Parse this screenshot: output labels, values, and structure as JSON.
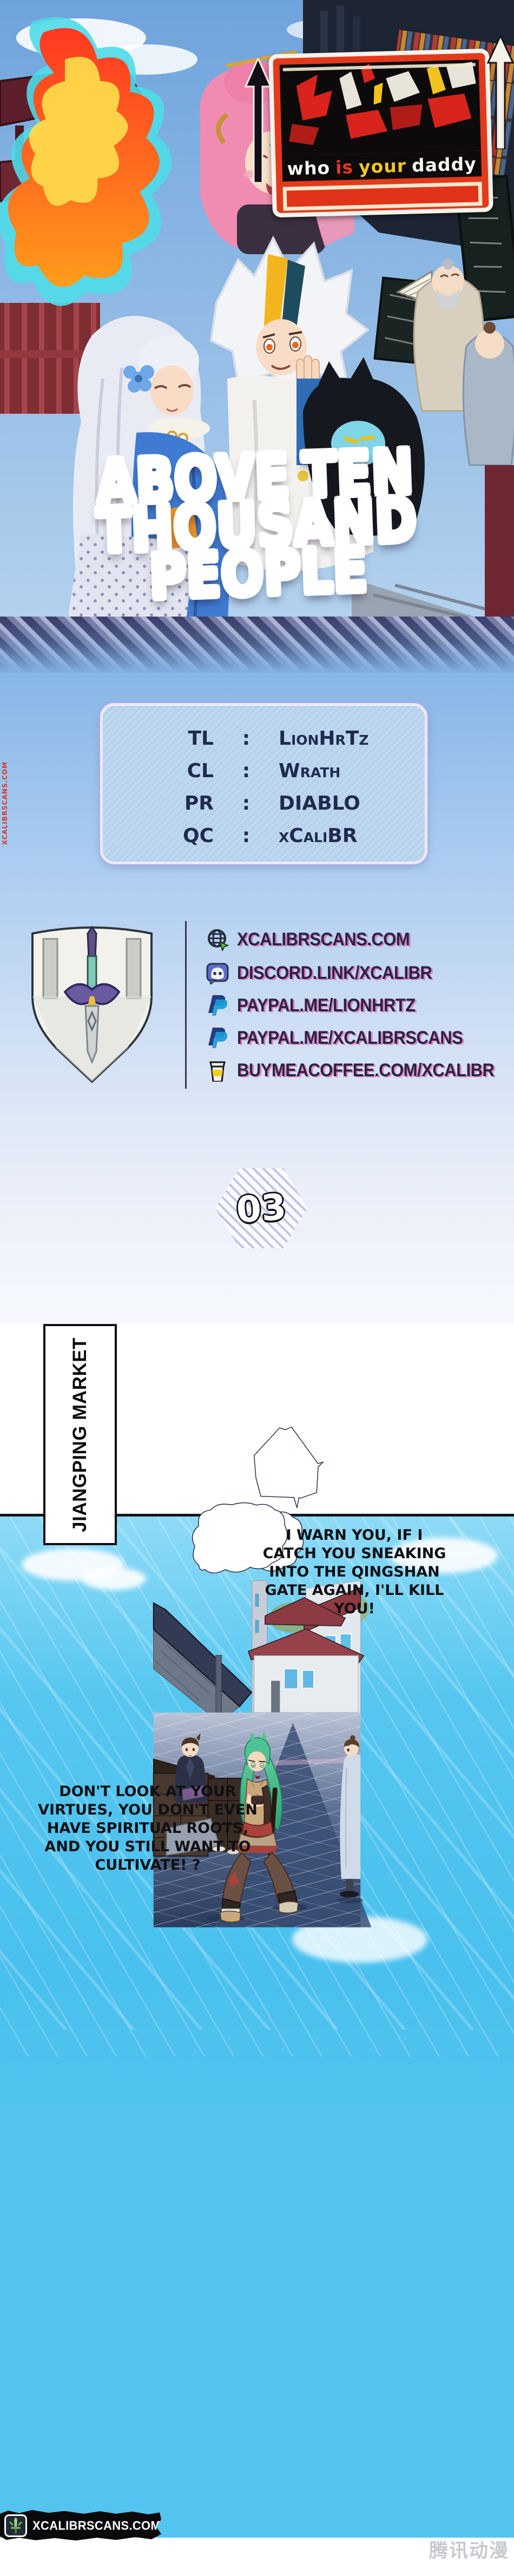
{
  "cover": {
    "logo": {
      "words": [
        "who",
        "is",
        "your",
        "daddy"
      ]
    },
    "title": {
      "w1": "ABOVE",
      "w2": "TEN",
      "w3": "THOUSAND",
      "w4": "PEOPLE"
    }
  },
  "side_watermark": "XCALIBRSCANS.COM",
  "credits": {
    "rows": [
      {
        "label": "TL",
        "sep": ":",
        "value": "LionHrTz"
      },
      {
        "label": "CL",
        "sep": ":",
        "value": "Wrath"
      },
      {
        "label": "PR",
        "sep": ":",
        "value": "DIABLO"
      },
      {
        "label": "QC",
        "sep": ":",
        "value": "xCaliBR"
      }
    ]
  },
  "links": {
    "items": [
      {
        "icon": "globe-icon",
        "text": "XCALIBRSCANS.COM"
      },
      {
        "icon": "discord-icon",
        "text": "DISCORD.LINK/XCALIBR"
      },
      {
        "icon": "paypal-icon",
        "text": "PAYPAL.ME/LIONHRTZ"
      },
      {
        "icon": "paypal-icon",
        "text": "PAYPAL.ME/XCALIBRSCANS"
      },
      {
        "icon": "coffee-icon",
        "text": "BUYMEACOFFEE.COM/XCALIBR"
      }
    ]
  },
  "chapter": {
    "number": "03"
  },
  "panel": {
    "location_banner": "JIANGPING MARKET",
    "bubble1": {
      "lines": [
        "I WARN YOU, IF I",
        "CATCH YOU SNEAKING",
        "INTO THE QINGSHAN",
        "GATE AGAIN, I'LL KILL",
        "YOU!"
      ]
    },
    "bubble2": {
      "lines": [
        "DON'T LOOK AT YOUR",
        "VIRTUES, YOU DON'T EVEN",
        "HAVE SPIRITUAL ROOTS,",
        "AND YOU STILL WANT TO",
        "CULTIVATE! ?"
      ]
    }
  },
  "footer": {
    "site": "XCALIBRSCANS.COM"
  },
  "publisher_watermark": "腾讯动漫",
  "colors": {
    "accent_red": "#e33a1c",
    "sky_blue": "#49c0ee",
    "outline_navy": "#1c2442",
    "link_text": "#2b2343"
  }
}
